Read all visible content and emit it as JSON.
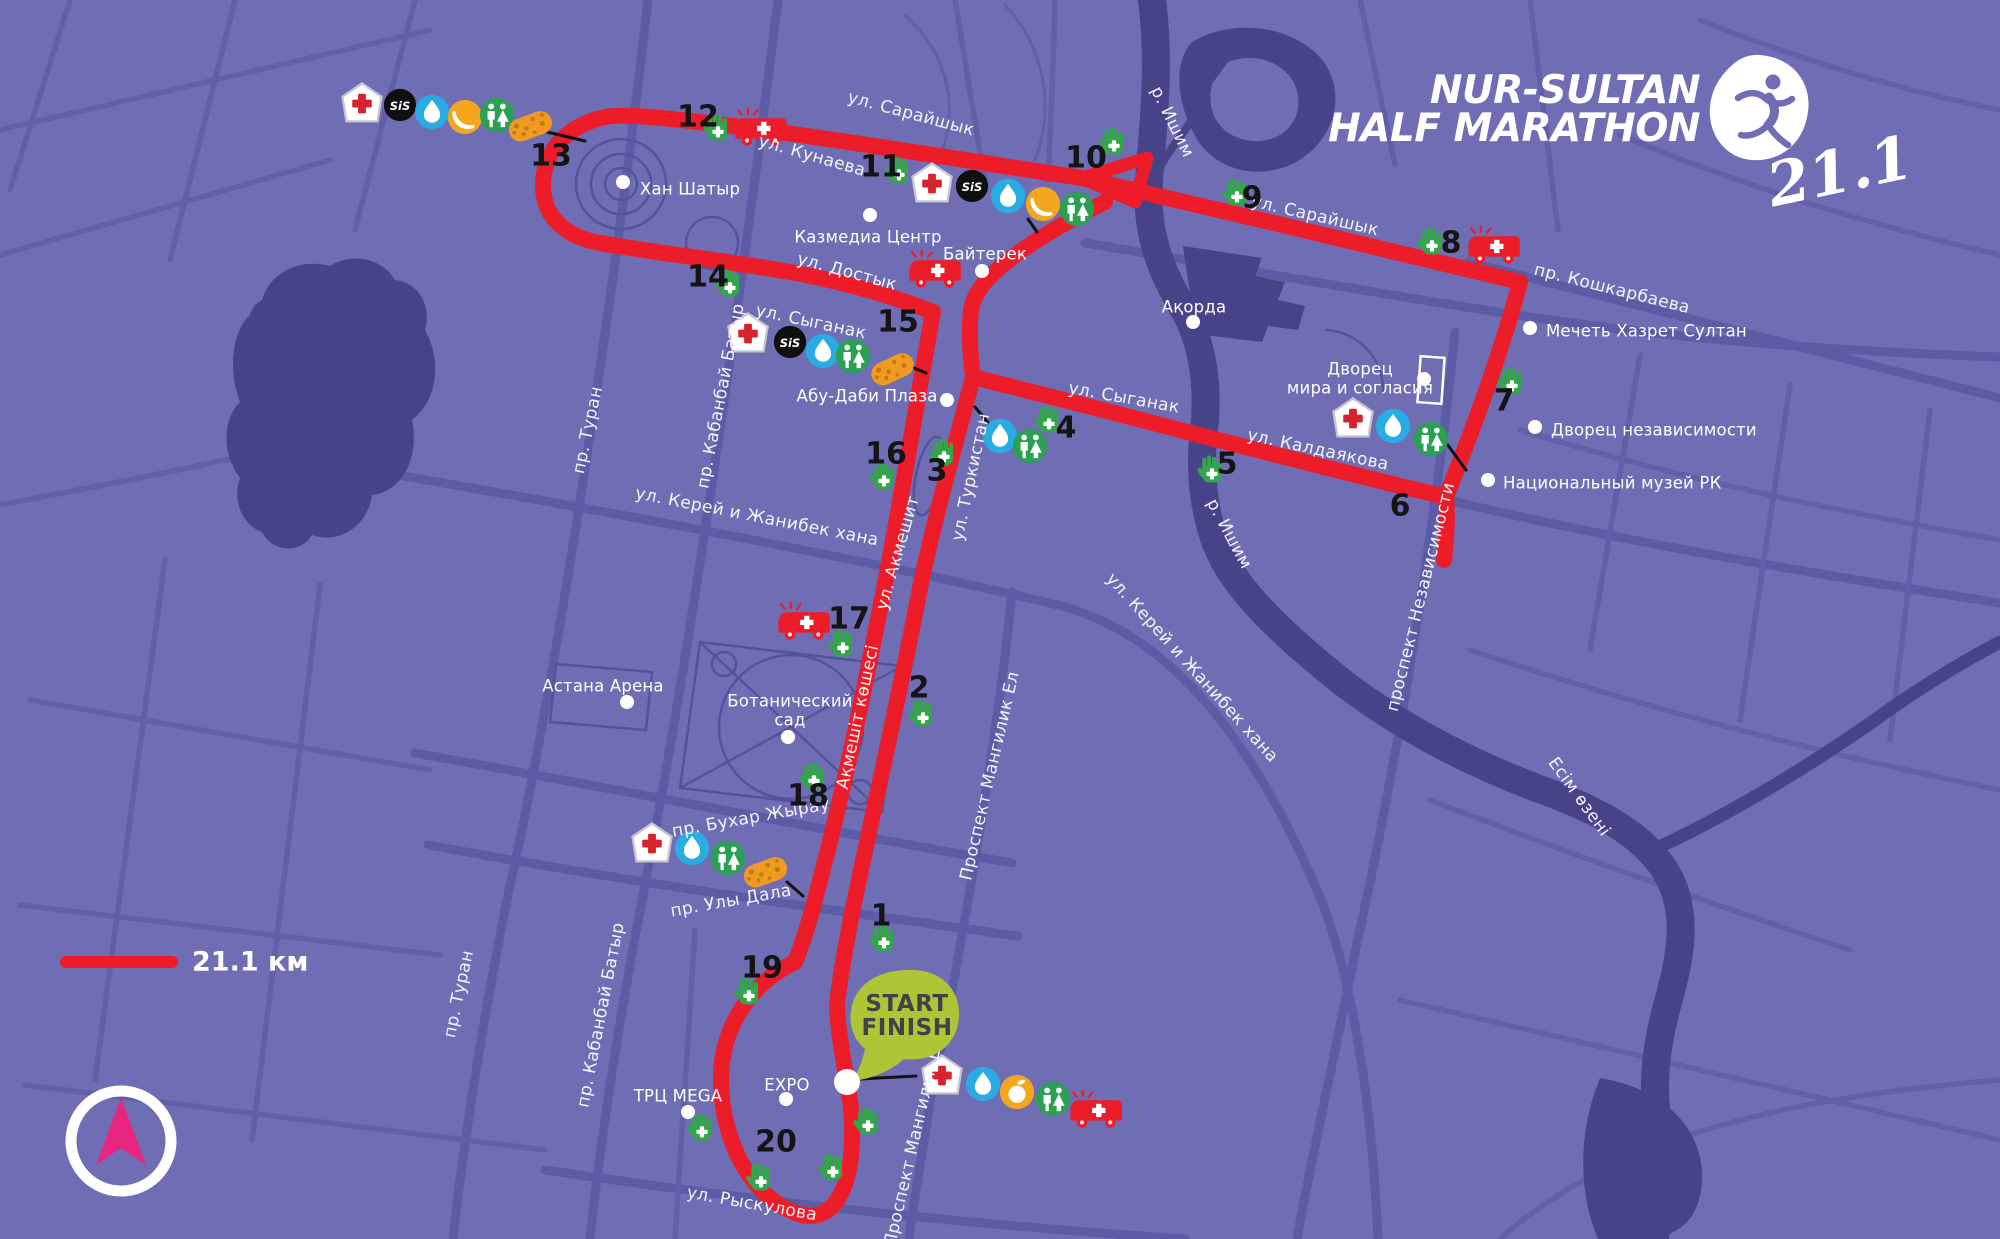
{
  "logo": {
    "line1": "NUR-SULTAN",
    "line2": "HALF MARATHON",
    "distance_script": "21.1"
  },
  "legend": {
    "label": "21.1 км"
  },
  "start_finish": {
    "line1": "START",
    "line2": "FINISH"
  },
  "icon_labels": {
    "sis": "SiS"
  },
  "colors": {
    "background": "#6f6eb4",
    "roads": "#5c5ba6",
    "water": "#474389",
    "route_red": "#ed1c29",
    "hand_green": "#33a64c",
    "toilet_green": "#2aa152",
    "water_blue": "#29abe3",
    "fruit_yellow": "#f4a71e",
    "sponge_orange": "#f09a22",
    "sis_black": "#0f0f0f",
    "start_bubble_green": "#aec636",
    "compass_magenta": "#e8257f",
    "label_white": "#ffffff"
  },
  "km_markers": [
    {
      "n": "1",
      "x": 881,
      "y": 916
    },
    {
      "n": "2",
      "x": 919,
      "y": 688
    },
    {
      "n": "3",
      "x": 937,
      "y": 471
    },
    {
      "n": "4",
      "x": 1066,
      "y": 428
    },
    {
      "n": "5",
      "x": 1227,
      "y": 464
    },
    {
      "n": "6",
      "x": 1400,
      "y": 506
    },
    {
      "n": "7",
      "x": 1504,
      "y": 401
    },
    {
      "n": "8",
      "x": 1451,
      "y": 243
    },
    {
      "n": "9",
      "x": 1252,
      "y": 198
    },
    {
      "n": "10",
      "x": 1086,
      "y": 158
    },
    {
      "n": "11",
      "x": 881,
      "y": 167
    },
    {
      "n": "12",
      "x": 698,
      "y": 117
    },
    {
      "n": "13",
      "x": 551,
      "y": 156
    },
    {
      "n": "14",
      "x": 708,
      "y": 277
    },
    {
      "n": "15",
      "x": 898,
      "y": 322
    },
    {
      "n": "16",
      "x": 886,
      "y": 454
    },
    {
      "n": "17",
      "x": 849,
      "y": 619
    },
    {
      "n": "18",
      "x": 808,
      "y": 796
    },
    {
      "n": "19",
      "x": 762,
      "y": 968
    },
    {
      "n": "20",
      "x": 776,
      "y": 1142
    }
  ],
  "icons": [
    {
      "type": "medical",
      "x": 362,
      "y": 103
    },
    {
      "type": "sis",
      "x": 400,
      "y": 105
    },
    {
      "type": "water",
      "x": 432,
      "y": 112
    },
    {
      "type": "banana",
      "x": 465,
      "y": 117
    },
    {
      "type": "toilet",
      "x": 497,
      "y": 115
    },
    {
      "type": "sponge",
      "x": 530,
      "y": 125,
      "rot": -20
    },
    {
      "type": "medical",
      "x": 932,
      "y": 183
    },
    {
      "type": "sis",
      "x": 972,
      "y": 186
    },
    {
      "type": "water",
      "x": 1008,
      "y": 196
    },
    {
      "type": "banana",
      "x": 1043,
      "y": 204
    },
    {
      "type": "toilet",
      "x": 1077,
      "y": 209
    },
    {
      "type": "medical",
      "x": 748,
      "y": 333
    },
    {
      "type": "sis",
      "x": 790,
      "y": 342
    },
    {
      "type": "water",
      "x": 823,
      "y": 351
    },
    {
      "type": "toilet",
      "x": 853,
      "y": 356
    },
    {
      "type": "sponge",
      "x": 892,
      "y": 368,
      "rot": -25
    },
    {
      "type": "water",
      "x": 1000,
      "y": 436
    },
    {
      "type": "toilet",
      "x": 1030,
      "y": 446
    },
    {
      "type": "medical",
      "x": 1353,
      "y": 418
    },
    {
      "type": "water",
      "x": 1393,
      "y": 426
    },
    {
      "type": "toilet",
      "x": 1431,
      "y": 439
    },
    {
      "type": "medical",
      "x": 652,
      "y": 843
    },
    {
      "type": "water",
      "x": 692,
      "y": 848
    },
    {
      "type": "toilet",
      "x": 728,
      "y": 858
    },
    {
      "type": "sponge",
      "x": 765,
      "y": 871,
      "rot": -20
    },
    {
      "type": "medical",
      "x": 942,
      "y": 1075
    },
    {
      "type": "water",
      "x": 983,
      "y": 1084
    },
    {
      "type": "orange",
      "x": 1017,
      "y": 1092
    },
    {
      "type": "toilet",
      "x": 1053,
      "y": 1099
    },
    {
      "type": "ambulance",
      "x": 762,
      "y": 128
    },
    {
      "type": "ambulance",
      "x": 936,
      "y": 270
    },
    {
      "type": "ambulance",
      "x": 1495,
      "y": 246
    },
    {
      "type": "ambulance",
      "x": 805,
      "y": 622
    },
    {
      "type": "ambulance",
      "x": 1097,
      "y": 1110
    },
    {
      "type": "hand",
      "x": 884,
      "y": 938
    },
    {
      "type": "hand",
      "x": 923,
      "y": 713
    },
    {
      "type": "hand",
      "x": 944,
      "y": 452
    },
    {
      "type": "hand",
      "x": 1049,
      "y": 419
    },
    {
      "type": "hand",
      "x": 1212,
      "y": 469
    },
    {
      "type": "hand",
      "x": 1512,
      "y": 381
    },
    {
      "type": "hand",
      "x": 1432,
      "y": 241
    },
    {
      "type": "hand",
      "x": 1237,
      "y": 192
    },
    {
      "type": "hand",
      "x": 1114,
      "y": 141
    },
    {
      "type": "hand",
      "x": 899,
      "y": 170
    },
    {
      "type": "hand",
      "x": 718,
      "y": 127
    },
    {
      "type": "hand",
      "x": 730,
      "y": 283
    },
    {
      "type": "hand",
      "x": 884,
      "y": 476
    },
    {
      "type": "hand",
      "x": 843,
      "y": 643
    },
    {
      "type": "hand",
      "x": 814,
      "y": 776
    },
    {
      "type": "hand",
      "x": 749,
      "y": 991
    },
    {
      "type": "hand",
      "x": 761,
      "y": 1177
    },
    {
      "type": "hand",
      "x": 702,
      "y": 1127
    },
    {
      "type": "hand",
      "x": 868,
      "y": 1121
    },
    {
      "type": "hand",
      "x": 833,
      "y": 1167
    }
  ],
  "leader_lines": [
    [
      547,
      132,
      585,
      141
    ],
    [
      1028,
      219,
      1037,
      232
    ],
    [
      902,
      363,
      926,
      373
    ],
    [
      975,
      407,
      995,
      431
    ],
    [
      1447,
      444,
      1466,
      470
    ],
    [
      787,
      882,
      803,
      896
    ],
    [
      860,
      1079,
      916,
      1076
    ]
  ],
  "places": [
    {
      "lines": [
        "Хан Шатыр"
      ],
      "x": 640,
      "y": 189,
      "dot": [
        623,
        182
      ],
      "anchor": "start"
    },
    {
      "lines": [
        "Казмедиа Центр"
      ],
      "x": 868,
      "y": 237,
      "dot": [
        870,
        215
      ],
      "anchor": "middle"
    },
    {
      "lines": [
        "Байтерек"
      ],
      "x": 985,
      "y": 254,
      "dot": [
        982,
        271
      ],
      "anchor": "middle"
    },
    {
      "lines": [
        "Ақорда"
      ],
      "x": 1194,
      "y": 307,
      "dot": [
        1193,
        322
      ],
      "anchor": "middle"
    },
    {
      "lines": [
        "Абу-Даби Плаза"
      ],
      "x": 867,
      "y": 396,
      "dot": [
        947,
        400
      ],
      "anchor": "middle"
    },
    {
      "lines": [
        "Дворец",
        "мира и согласия"
      ],
      "x": 1360,
      "y": 369,
      "dot": [
        1424,
        379
      ],
      "anchor": "middle"
    },
    {
      "lines": [
        "Мечеть Хазрет Султан"
      ],
      "x": 1546,
      "y": 331,
      "dot": [
        1530,
        328
      ],
      "anchor": "start"
    },
    {
      "lines": [
        "Дворец независимости"
      ],
      "x": 1551,
      "y": 430,
      "dot": [
        1535,
        427
      ],
      "anchor": "start"
    },
    {
      "lines": [
        "Национальный музей РК"
      ],
      "x": 1503,
      "y": 483,
      "dot": [
        1488,
        480
      ],
      "anchor": "start"
    },
    {
      "lines": [
        "Астана Арена"
      ],
      "x": 603,
      "y": 686,
      "dot": [
        627,
        702
      ],
      "anchor": "middle"
    },
    {
      "lines": [
        "Ботанический",
        "сад"
      ],
      "x": 790,
      "y": 701,
      "dot": [
        788,
        737
      ],
      "anchor": "middle"
    },
    {
      "lines": [
        "EXPO"
      ],
      "x": 787,
      "y": 1085,
      "dot": [
        786,
        1099
      ],
      "anchor": "middle"
    },
    {
      "lines": [
        "ТРЦ MEGA"
      ],
      "x": 678,
      "y": 1096,
      "dot": [
        688,
        1112
      ],
      "anchor": "middle"
    }
  ],
  "map_labels": [
    {
      "text": "ул. Сарайшык",
      "x": 911,
      "y": 114,
      "rot": 15
    },
    {
      "text": "ул. Кунаева",
      "x": 812,
      "y": 156,
      "rot": 16
    },
    {
      "text": "ул. Достык",
      "x": 847,
      "y": 272,
      "rot": 15
    },
    {
      "text": "ул. Сыганак",
      "x": 811,
      "y": 322,
      "rot": 12
    },
    {
      "text": "ул. Сарайшык",
      "x": 1315,
      "y": 216,
      "rot": 13
    },
    {
      "text": "пр. Кошкарбаева",
      "x": 1612,
      "y": 289,
      "rot": 14
    },
    {
      "text": "ул. Сыганак",
      "x": 1124,
      "y": 398,
      "rot": 10
    },
    {
      "text": "ул. Калдаякова",
      "x": 1318,
      "y": 450,
      "rot": 12
    },
    {
      "text": "ул. Туркистан",
      "x": 971,
      "y": 477,
      "rot": -78
    },
    {
      "text": "ул. Акмешит",
      "x": 898,
      "y": 553,
      "rot": -74
    },
    {
      "text": "Ақмешіт көшесі",
      "x": 858,
      "y": 717,
      "rot": -78
    },
    {
      "text": "Проспект Мангилик Ел",
      "x": 990,
      "y": 776,
      "rot": -77
    },
    {
      "text": "Проспект Мангилик Ел",
      "x": 914,
      "y": 1142,
      "rot": -77
    },
    {
      "text": "пр. Туран",
      "x": 588,
      "y": 430,
      "rot": -78
    },
    {
      "text": "пр. Кабанбай Батыр",
      "x": 721,
      "y": 396,
      "rot": -79
    },
    {
      "text": "пр. Туран",
      "x": 459,
      "y": 994,
      "rot": -78
    },
    {
      "text": "пр. Кабанбай Батыр",
      "x": 601,
      "y": 1015,
      "rot": -79
    },
    {
      "text": "пр. Бухар Жырау",
      "x": 751,
      "y": 818,
      "rot": -10
    },
    {
      "text": "пр. Улы Дала",
      "x": 731,
      "y": 901,
      "rot": -10
    },
    {
      "text": "ул. Рыскулова",
      "x": 752,
      "y": 1204,
      "rot": 10
    },
    {
      "text": "ул. Керей и Жанибек хана",
      "x": 757,
      "y": 517,
      "rot": 11
    },
    {
      "text": "ул. Керей и Жанибек хана",
      "x": 1192,
      "y": 668,
      "rot": 48
    },
    {
      "text": "проспект Независимости",
      "x": 1421,
      "y": 597,
      "rot": -76
    },
    {
      "text": "р. Ишим",
      "x": 1172,
      "y": 122,
      "rot": 64
    },
    {
      "text": "р. Ишим",
      "x": 1229,
      "y": 534,
      "rot": 62
    },
    {
      "text": "Есім өзені",
      "x": 1579,
      "y": 797,
      "rot": 54
    }
  ]
}
